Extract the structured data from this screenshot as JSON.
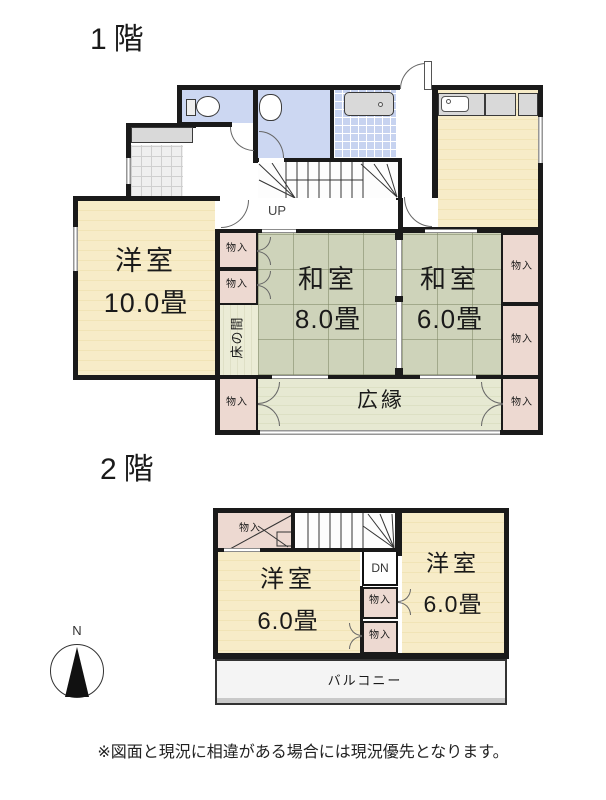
{
  "floor1": {
    "title": "1階",
    "up_label": "UP",
    "western_room": {
      "name": "洋室",
      "size": "10.0畳"
    },
    "japanese_room_large": {
      "name": "和室",
      "size": "8.0畳"
    },
    "japanese_room_small": {
      "name": "和室",
      "size": "6.0畳"
    },
    "veranda_label": "広縁",
    "tokonoma_label": "床の間"
  },
  "floor2": {
    "title": "2階",
    "dn_label": "DN",
    "western_room_left": {
      "name": "洋室",
      "size": "6.0畳"
    },
    "western_room_right": {
      "name": "洋室",
      "size": "6.0畳"
    },
    "balcony_label": "バルコニー"
  },
  "common": {
    "closet_label": "物入",
    "north_label": "N"
  },
  "footer": {
    "disclaimer": "※図面と現況に相違がある場合には現況優先となります。"
  },
  "colors": {
    "wall": "#1a1a1a",
    "wood_floor": "#f7ecc8",
    "tatami_floor": "#ced3ba",
    "closet_fill": "#edd9d1",
    "wet_area": "#ccd7f2",
    "tokonoma_fill": "#ebecd6",
    "veranda_fill": "#e6e9d2",
    "balcony_fill": "#f4f4f4",
    "fixture_gray": "#d9d9d9"
  }
}
